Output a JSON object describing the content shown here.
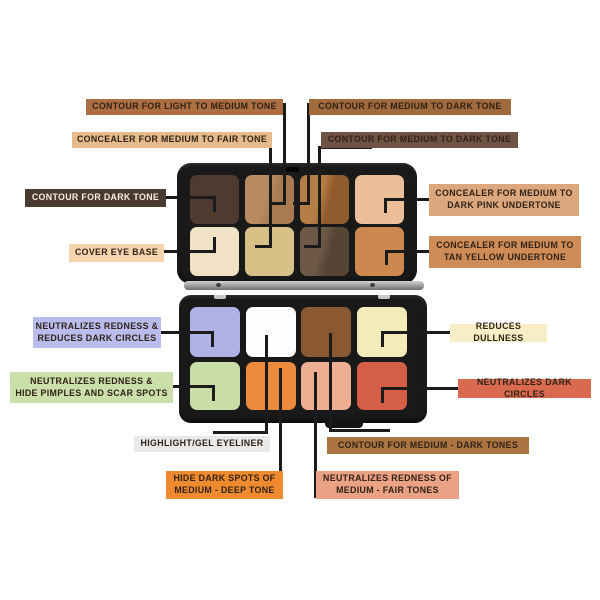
{
  "theme": {
    "background": "#ffffff",
    "line_color": "#1b1b1b",
    "text_dark": "#2f2217",
    "text_light": "#f7efe4",
    "case_color": "#191919"
  },
  "palettes": [
    {
      "id": "top",
      "name": "contour-concealer-palette",
      "pans": [
        {
          "name": "contour-dark-tone",
          "color": "#4e3a2e"
        },
        {
          "name": "contour-light-to-medium-tone",
          "color": "#b88b60",
          "color2": "#aa7b51"
        },
        {
          "name": "contour-medium-to-dark-tone",
          "color": "#b47d46",
          "color2": "#8f5a2c"
        },
        {
          "name": "concealer-medium-dark-pink-undertone",
          "color": "#edbf98"
        },
        {
          "name": "cover-eye-base",
          "color": "#f2e2c5"
        },
        {
          "name": "concealer-medium-to-fair-tone",
          "color": "#d7c187"
        },
        {
          "name": "contour-medium-to-dark-tone-2",
          "color": "#6e5947",
          "color2": "#564435"
        },
        {
          "name": "concealer-medium-tan-yellow-undertone",
          "color": "#cd8850"
        }
      ]
    },
    {
      "id": "bottom",
      "name": "color-corrector-palette",
      "pans": [
        {
          "name": "neutralizes-redness-reduces-dark-circles",
          "color": "#afb2e5"
        },
        {
          "name": "highlight-gel-eyeliner",
          "color": "#fdfdfd"
        },
        {
          "name": "contour-medium-dark-tones",
          "color": "#8a5931"
        },
        {
          "name": "reduces-dullness",
          "color": "#f3ebb8"
        },
        {
          "name": "neutralizes-redness-hide-pimples",
          "color": "#c9dda7"
        },
        {
          "name": "hide-dark-spots-medium-deep",
          "color": "#ec8a3e"
        },
        {
          "name": "neutralizes-redness-medium-fair",
          "color": "#eeae92"
        },
        {
          "name": "neutralizes-dark-circles",
          "color": "#d55f46"
        }
      ]
    }
  ],
  "labels": [
    {
      "id": "contour-light-to-medium-tone",
      "text": "CONTOUR FOR LIGHT TO MEDIUM TONE",
      "bg": "#ad6e41",
      "x": 86,
      "y": 99,
      "w": 197,
      "h": 16
    },
    {
      "id": "contour-medium-to-dark-tone-1",
      "text": "CONTOUR FOR MEDIUM TO DARK TONE",
      "bg": "#a06a3c",
      "x": 309,
      "y": 99,
      "w": 202,
      "h": 16
    },
    {
      "id": "concealer-medium-to-fair-tone",
      "text": "CONCEALER FOR MEDIUM TO FAIR TONE",
      "bg": "#e5bb8c",
      "x": 72,
      "y": 132,
      "w": 200,
      "h": 16
    },
    {
      "id": "contour-medium-to-dark-tone-2",
      "text": "CONTOUR FOR MEDIUM TO DARK TONE",
      "bg": "#6f5443",
      "x": 321,
      "y": 132,
      "w": 197,
      "h": 16
    },
    {
      "id": "contour-dark-tone",
      "text": "CONTOUR FOR DARK TONE",
      "bg": "#4a3b31",
      "fg": "#f7efe4",
      "x": 25,
      "y": 189,
      "w": 141,
      "h": 18
    },
    {
      "id": "concealer-medium-dark-pink-undertone",
      "text": "CONCEALER FOR MEDIUM TO\nDARK PINK UNDERTONE",
      "bg": "#dda77d",
      "x": 429,
      "y": 184,
      "w": 150,
      "h": 32
    },
    {
      "id": "cover-eye-base",
      "text": "COVER EYE BASE",
      "bg": "#f6d5ae",
      "x": 69,
      "y": 244,
      "w": 95,
      "h": 18
    },
    {
      "id": "concealer-medium-tan-yellow-undertone",
      "text": "CONCEALER FOR MEDIUM TO\nTAN YELLOW UNDERTONE",
      "bg": "#cf8c57",
      "x": 429,
      "y": 236,
      "w": 152,
      "h": 32
    },
    {
      "id": "neutralizes-redness-reduces-dark-circles",
      "text": "NEUTRALIZES REDNESS &\nREDUCES DARK CIRCLES",
      "bg": "#b9bcec",
      "x": 33,
      "y": 317,
      "w": 128,
      "h": 31
    },
    {
      "id": "reduces-dullness",
      "text": "REDUCES DULLNESS",
      "bg": "#f8eec5",
      "x": 450,
      "y": 324,
      "w": 97,
      "h": 18
    },
    {
      "id": "neutralizes-redness-hide-pimples",
      "text": "NEUTRALIZES REDNESS &\nHIDE PIMPLES AND SCAR SPOTS",
      "bg": "#cadfa9",
      "x": 10,
      "y": 372,
      "w": 163,
      "h": 31
    },
    {
      "id": "neutralizes-dark-circles",
      "text": "NEUTRALIZES DARK CIRCLES",
      "bg": "#d96a4f",
      "x": 458,
      "y": 379,
      "w": 133,
      "h": 19
    },
    {
      "id": "highlight-gel-eyeliner",
      "text": "HIGHLIGHT/GEL EYELINER",
      "bg": "#e9e9e9",
      "x": 134,
      "y": 436,
      "w": 136,
      "h": 16
    },
    {
      "id": "contour-medium-dark-tones",
      "text": "CONTOUR FOR MEDIUM - DARK TONES",
      "bg": "#aa7340",
      "x": 327,
      "y": 437,
      "w": 202,
      "h": 17
    },
    {
      "id": "hide-dark-spots-medium-deep",
      "text": "HIDE DARK SPOTS OF\nMEDIUM - DEEP TONE",
      "bg": "#f08a2e",
      "x": 166,
      "y": 471,
      "w": 117,
      "h": 28
    },
    {
      "id": "neutralizes-redness-medium-fair",
      "text": "NEUTRALIZES REDNESS OF\nMEDIUM - FAIR TONES",
      "bg": "#eba183",
      "x": 316,
      "y": 471,
      "w": 143,
      "h": 28
    }
  ],
  "connectors": [
    {
      "to": "contour-light-to-medium-tone",
      "segments": [
        [
          283,
          103,
          3,
          102
        ],
        [
          269,
          202,
          17,
          3
        ]
      ]
    },
    {
      "to": "contour-medium-to-dark-tone-1",
      "segments": [
        [
          307,
          103,
          3,
          102
        ],
        [
          293,
          202,
          17,
          3
        ]
      ]
    },
    {
      "to": "concealer-medium-to-fair-tone",
      "segments": [
        [
          269,
          139,
          3,
          109
        ],
        [
          255,
          245,
          17,
          3
        ]
      ]
    },
    {
      "to": "contour-medium-to-dark-tone-2",
      "segments": [
        [
          320,
          146,
          52,
          3
        ],
        [
          318,
          146,
          3,
          102
        ],
        [
          304,
          245,
          17,
          3
        ]
      ]
    },
    {
      "to": "contour-dark-tone",
      "segments": [
        [
          164,
          196,
          52,
          3
        ],
        [
          213,
          196,
          3,
          16
        ]
      ]
    },
    {
      "to": "concealer-medium-dark-pink-undertone",
      "segments": [
        [
          384,
          198,
          45,
          3
        ],
        [
          384,
          198,
          3,
          15
        ]
      ]
    },
    {
      "to": "cover-eye-base",
      "segments": [
        [
          162,
          250,
          54,
          3
        ],
        [
          213,
          237,
          3,
          16
        ]
      ]
    },
    {
      "to": "concealer-medium-tan-yellow-undertone",
      "segments": [
        [
          385,
          250,
          44,
          3
        ],
        [
          385,
          250,
          3,
          15
        ]
      ]
    },
    {
      "to": "neutralizes-redness-reduces-dark-circles",
      "segments": [
        [
          158,
          331,
          56,
          3
        ],
        [
          211,
          331,
          3,
          16
        ]
      ]
    },
    {
      "to": "reduces-dullness",
      "segments": [
        [
          381,
          331,
          69,
          3
        ],
        [
          381,
          331,
          3,
          16
        ]
      ]
    },
    {
      "to": "neutralizes-redness-hide-pimples",
      "segments": [
        [
          170,
          385,
          45,
          3
        ],
        [
          212,
          385,
          3,
          16
        ]
      ]
    },
    {
      "to": "neutralizes-dark-circles",
      "segments": [
        [
          381,
          387,
          77,
          3
        ],
        [
          381,
          387,
          3,
          16
        ]
      ]
    },
    {
      "to": "highlight-gel-eyeliner",
      "segments": [
        [
          265,
          335,
          3,
          99
        ],
        [
          213,
          431,
          55,
          3
        ]
      ]
    },
    {
      "to": "contour-medium-dark-tones",
      "segments": [
        [
          329,
          333,
          3,
          99
        ],
        [
          329,
          429,
          61,
          3
        ]
      ]
    },
    {
      "to": "hide-dark-spots-medium-deep",
      "segments": [
        [
          279,
          368,
          3,
          130
        ]
      ]
    },
    {
      "to": "neutralizes-redness-medium-fair",
      "segments": [
        [
          314,
          372,
          3,
          126
        ]
      ]
    }
  ]
}
